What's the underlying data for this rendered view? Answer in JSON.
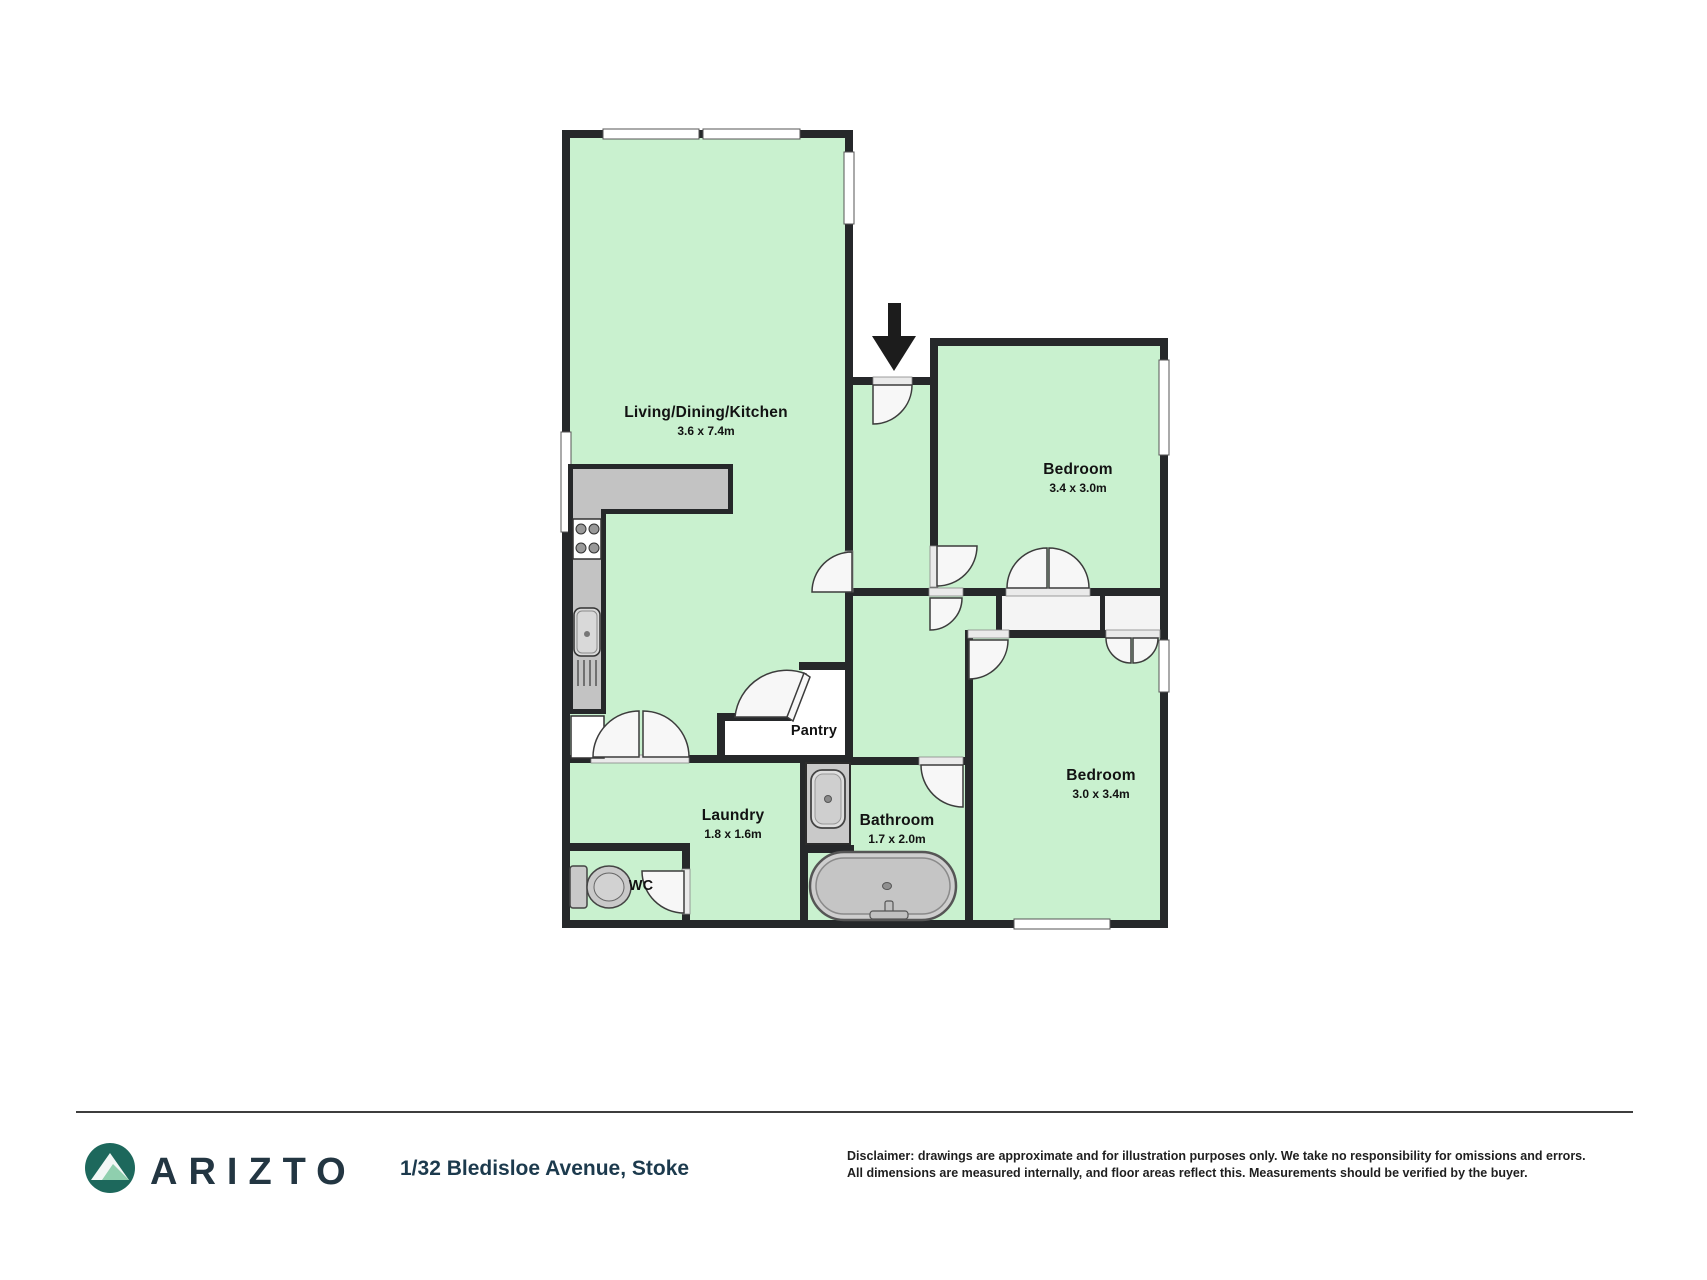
{
  "plan": {
    "rooms": [
      {
        "name": "Living/Dining/Kitchen",
        "dims": "3.6 x 7.4m"
      },
      {
        "name": "Bedroom",
        "dims": "3.4 x 3.0m"
      },
      {
        "name": "Bedroom",
        "dims": "3.0 x 3.4m"
      },
      {
        "name": "Pantry",
        "dims": ""
      },
      {
        "name": "Laundry",
        "dims": "1.8 x 1.6m"
      },
      {
        "name": "Bathroom",
        "dims": "1.7 x 2.0m"
      },
      {
        "name": "WC",
        "dims": ""
      }
    ],
    "colors": {
      "floor": "#c9f1cf",
      "wall": "#26282a",
      "fixture": "#c9c9c9",
      "counter": "#c3c3c3",
      "door": "#f7f7f7",
      "wardrobe": "#f4f4f4",
      "arrow": "#1c1c1c"
    },
    "icons": [
      "entry-arrow-icon",
      "stove-icon",
      "kitchen-sink-icon",
      "sink-drainer-icon",
      "toilet-icon",
      "bath-icon",
      "vanity-sink-icon",
      "mountain-logo-icon"
    ]
  },
  "footer": {
    "brand": "ARIZTO",
    "address": "1/32 Bledisloe Avenue, Stoke",
    "disclaimer_line1": "Disclaimer: drawings are approximate and for illustration purposes only. We take no responsibility for omissions and errors.",
    "disclaimer_line2": "All dimensions are measured internally, and floor areas reflect this. Measurements should be verified by the buyer.",
    "logo_circle_color": "#1d685c"
  }
}
